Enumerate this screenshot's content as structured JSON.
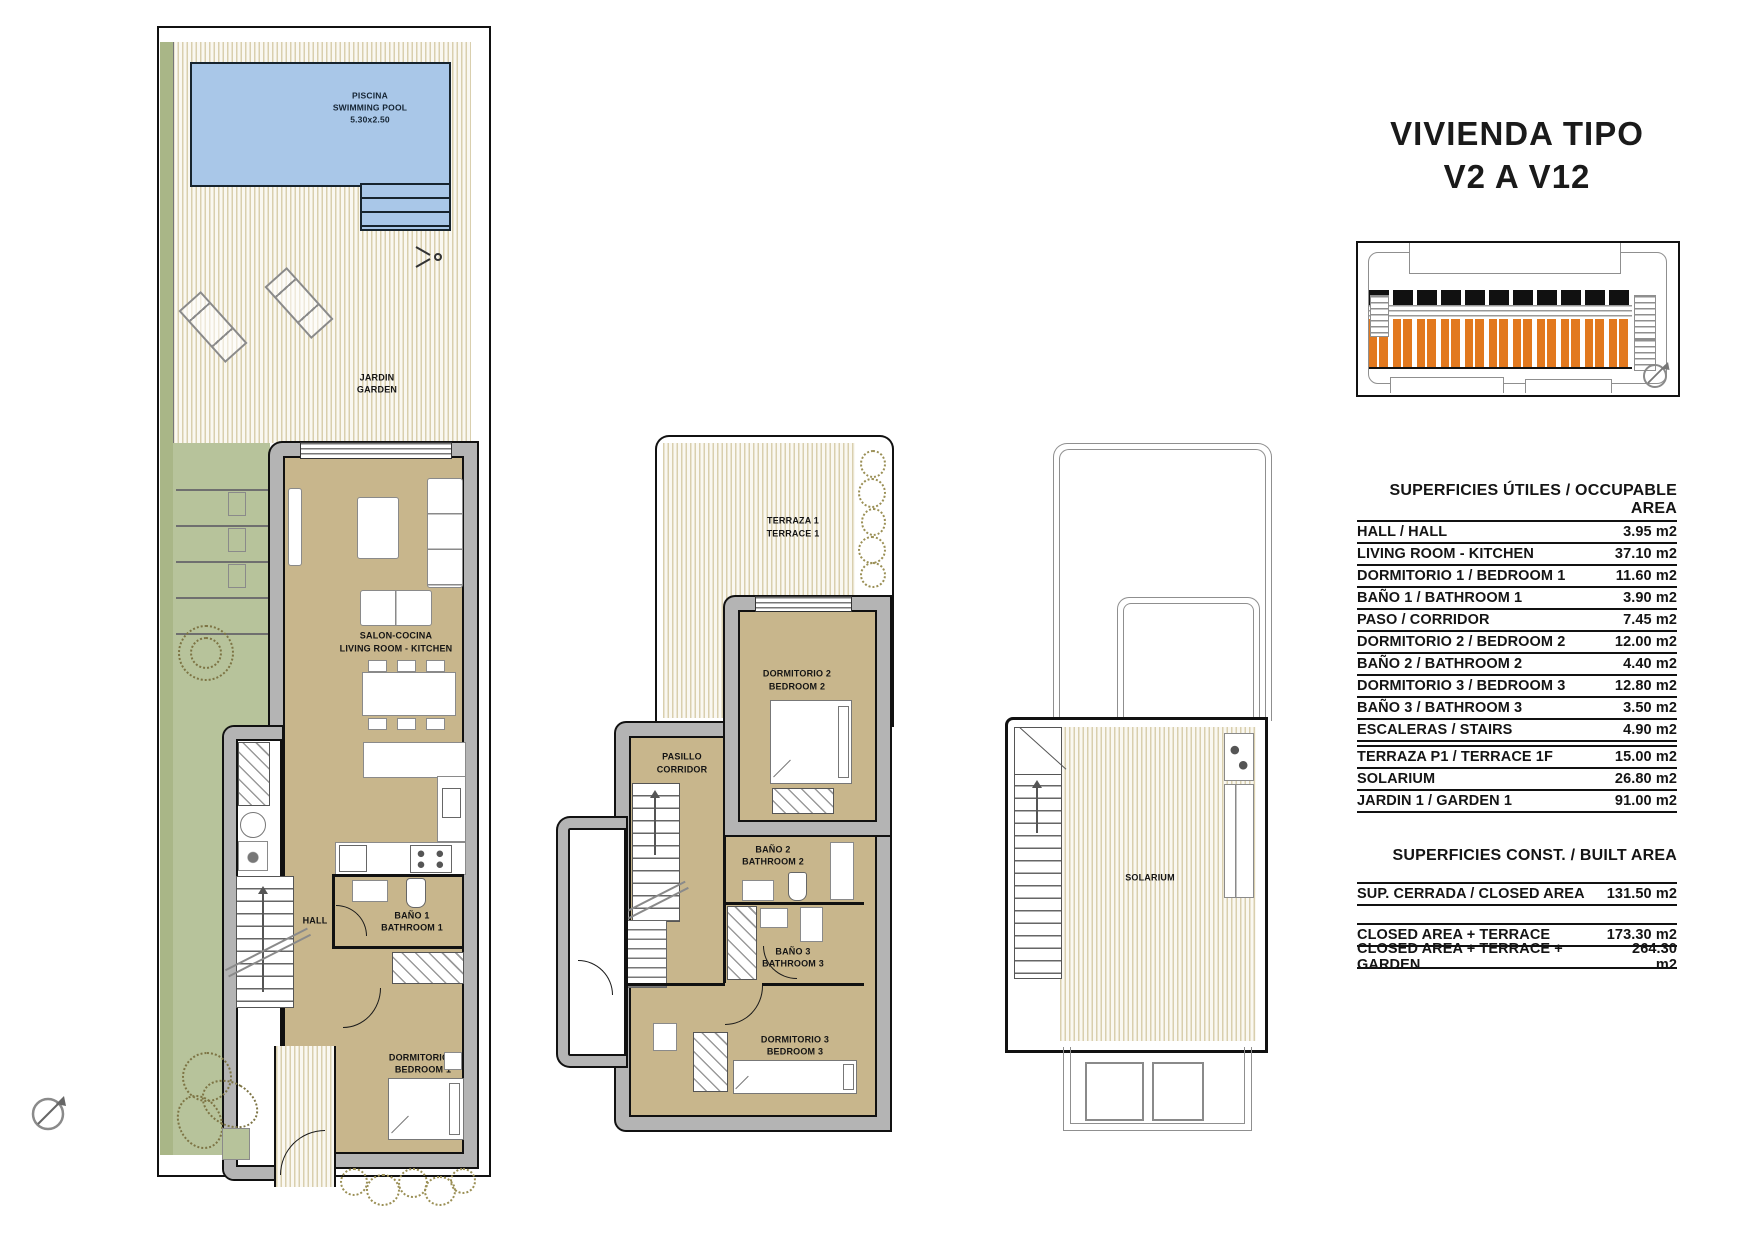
{
  "title": {
    "line1": "VIVIENDA TIPO",
    "line2": "V2 A V12"
  },
  "plans": {
    "ground": {
      "pool": {
        "l1": "PISCINA",
        "l2": "SWIMMING POOL",
        "l3": "5.30x2.50"
      },
      "garden": {
        "l1": "JARDIN",
        "l2": "GARDEN"
      },
      "living": {
        "l1": "SALON-COCINA",
        "l2": "LIVING ROOM - KITCHEN"
      },
      "hall": {
        "l1": "HALL"
      },
      "bath1": {
        "l1": "BAÑO 1",
        "l2": "BATHROOM 1"
      },
      "bed1": {
        "l1": "DORMITORIO 1",
        "l2": "BEDROOM 1"
      }
    },
    "first": {
      "terrace": {
        "l1": "TERRAZA 1",
        "l2": "TERRACE 1"
      },
      "bed2": {
        "l1": "DORMITORIO 2",
        "l2": "BEDROOM 2"
      },
      "corridor": {
        "l1": "PASILLO",
        "l2": "CORRIDOR"
      },
      "bath2": {
        "l1": "BAÑO 2",
        "l2": "BATHROOM 2"
      },
      "bath3": {
        "l1": "BAÑO 3",
        "l2": "BATHROOM 3"
      },
      "bed3": {
        "l1": "DORMITORIO 3",
        "l2": "BEDROOM 3"
      }
    },
    "roof": {
      "solarium": {
        "l1": "SOLARIUM"
      }
    }
  },
  "tables": {
    "occupable": {
      "header": "SUPERFICIES ÚTILES / OCCUPABLE AREA",
      "rows": [
        {
          "label": "HALL / HALL",
          "value": "3.95 m2"
        },
        {
          "label": "LIVING ROOM - KITCHEN",
          "value": "37.10 m2"
        },
        {
          "label": "DORMITORIO 1 / BEDROOM 1",
          "value": "11.60 m2"
        },
        {
          "label": "BAÑO 1 / BATHROOM 1",
          "value": "3.90 m2"
        },
        {
          "label": "PASO / CORRIDOR",
          "value": "7.45 m2"
        },
        {
          "label": "DORMITORIO 2 / BEDROOM 2",
          "value": "12.00 m2"
        },
        {
          "label": "BAÑO 2 / BATHROOM 2",
          "value": "4.40 m2"
        },
        {
          "label": "DORMITORIO 3 / BEDROOM 3",
          "value": "12.80 m2"
        },
        {
          "label": "BAÑO 3 / BATHROOM 3",
          "value": "3.50 m2"
        },
        {
          "label": "ESCALERAS / STAIRS",
          "value": "4.90 m2"
        }
      ],
      "rows2": [
        {
          "label": "TERRAZA P1 / TERRACE 1F",
          "value": "15.00 m2"
        },
        {
          "label": "SOLARIUM",
          "value": "26.80 m2"
        },
        {
          "label": "JARDIN 1 / GARDEN 1",
          "value": "91.00 m2"
        }
      ]
    },
    "built": {
      "header": "SUPERFICIES CONST. / BUILT AREA",
      "rows": [
        {
          "label": "SUP. CERRADA / CLOSED AREA",
          "value": "131.50 m2"
        }
      ],
      "rows2": [
        {
          "label": "CLOSED AREA + TERRACE",
          "value": "173.30 m2"
        },
        {
          "label": "CLOSED AREA + TERRACE + GARDEN",
          "value": "264.30 m2"
        }
      ]
    }
  },
  "colors": {
    "pool_blue": "#a9c7e8",
    "deck_stripe": "#d9cfae",
    "garden_green": "#b7c39b",
    "boundary_green": "#a9b687",
    "wall_gray": "#b4b4b4",
    "floor_tan": "#c8b68c",
    "unit_highlight_orange": "#e2791f",
    "line_black": "#111111"
  }
}
